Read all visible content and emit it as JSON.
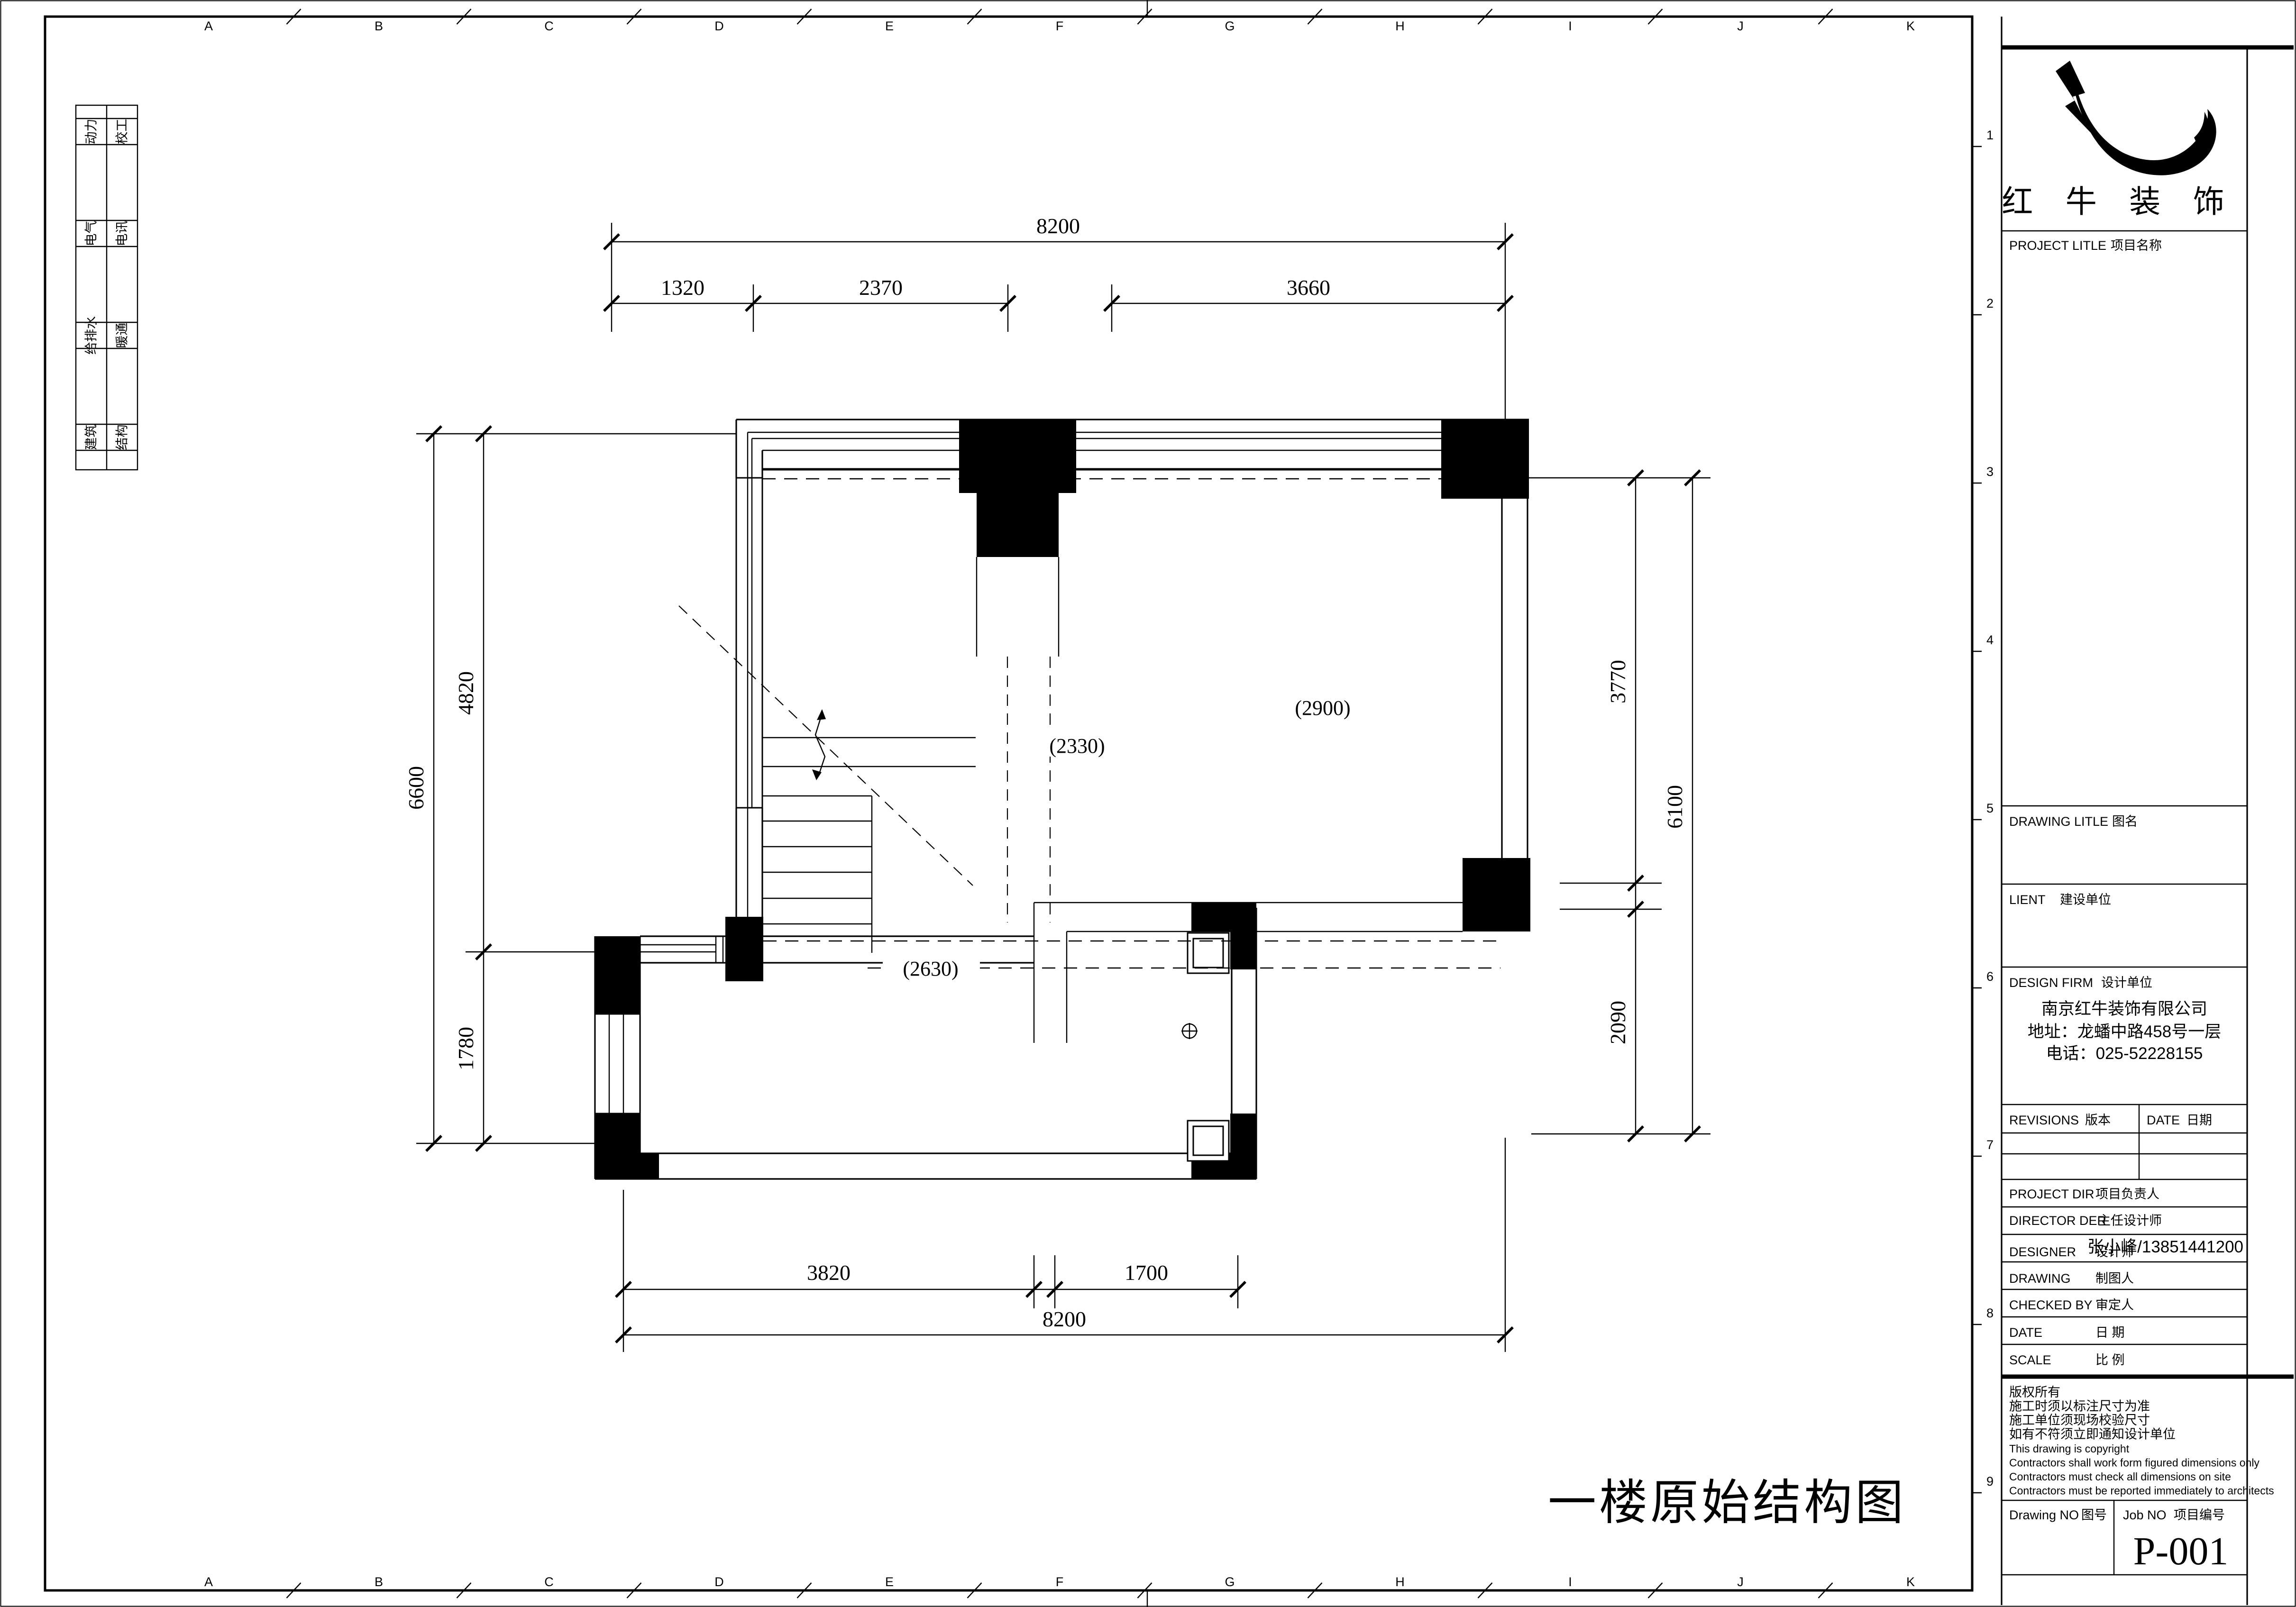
{
  "company": {
    "logo_icon": "bull-horn-swoosh-logo",
    "name_spaced": "红 牛 装 饰"
  },
  "title_block": {
    "project_title": {
      "en": "PROJECT LITLE",
      "zh": "项目名称"
    },
    "drawing_title": {
      "en": "DRAWING LITLE",
      "zh": "图名"
    },
    "client": {
      "en": "LIENT",
      "zh": "建设单位"
    },
    "design_firm": {
      "en": "DESIGN FIRM",
      "zh": "设计单位"
    },
    "firm_name": "南京红牛装饰有限公司",
    "firm_address": "地址：龙蟠中路458号一层",
    "firm_phone": "电话：025-52228155",
    "revisions": {
      "en": "REVISIONS",
      "zh": "版本"
    },
    "date_col": {
      "en": "DATE",
      "zh": "日期"
    },
    "project_dir": {
      "en": "PROJECT DIR",
      "zh": "项目负责人"
    },
    "director": {
      "en": "DIRECTOR DER",
      "zh": "主任设计师"
    },
    "director_value": "张小峰/13851441200",
    "designer": {
      "en": "DESIGNER",
      "zh": "设计师"
    },
    "drawing_by": {
      "en": "DRAWING",
      "zh": "制图人"
    },
    "checked_by": {
      "en": "CHECKED BY",
      "zh": "审定人"
    },
    "date_row": {
      "en": "DATE",
      "zh": "日  期"
    },
    "scale_row": {
      "en": "SCALE",
      "zh": "比  例"
    },
    "copyright_lines": [
      "版权所有",
      "施工时须以标注尺寸为准",
      "施工单位须现场校验尺寸",
      "如有不符须立即通知设计单位",
      "This drawing is copyright",
      "Contractors shall work form figured dimensions only",
      "Contractors must check all dimensions on site",
      "Contractors must be reported immediately to architects"
    ],
    "drawing_no": {
      "en": "Drawing NO",
      "zh": "图号"
    },
    "job_no": {
      "en": "Job NO",
      "zh": "项目编号"
    },
    "job_no_value": "P-001"
  },
  "sheet": {
    "drawing_title": "一楼原始结构图",
    "grid_columns": [
      "A",
      "B",
      "C",
      "D",
      "E",
      "F",
      "G",
      "H",
      "I",
      "J",
      "K"
    ],
    "grid_rows": [
      "1",
      "2",
      "3",
      "4",
      "5",
      "6",
      "7",
      "8",
      "9"
    ]
  },
  "sidebar": {
    "rows": [
      [
        "动力",
        "校工"
      ],
      [
        "电气",
        "电讯"
      ],
      [
        "给排水",
        "暖通"
      ],
      [
        "建筑",
        "结构"
      ]
    ]
  },
  "plan": {
    "dims": {
      "top_total": "8200",
      "top_segments": [
        "1320",
        "2370",
        "3660"
      ],
      "left_total": "6600",
      "left_segments": [
        "4820",
        "1780"
      ],
      "right_total": "6100",
      "right_segments": [
        "3770",
        "2090"
      ],
      "bottom_segments": [
        "3820",
        "1700"
      ],
      "bottom_total": "8200"
    },
    "room_labels": [
      "(2330)",
      "(2900)",
      "(2630)"
    ]
  }
}
